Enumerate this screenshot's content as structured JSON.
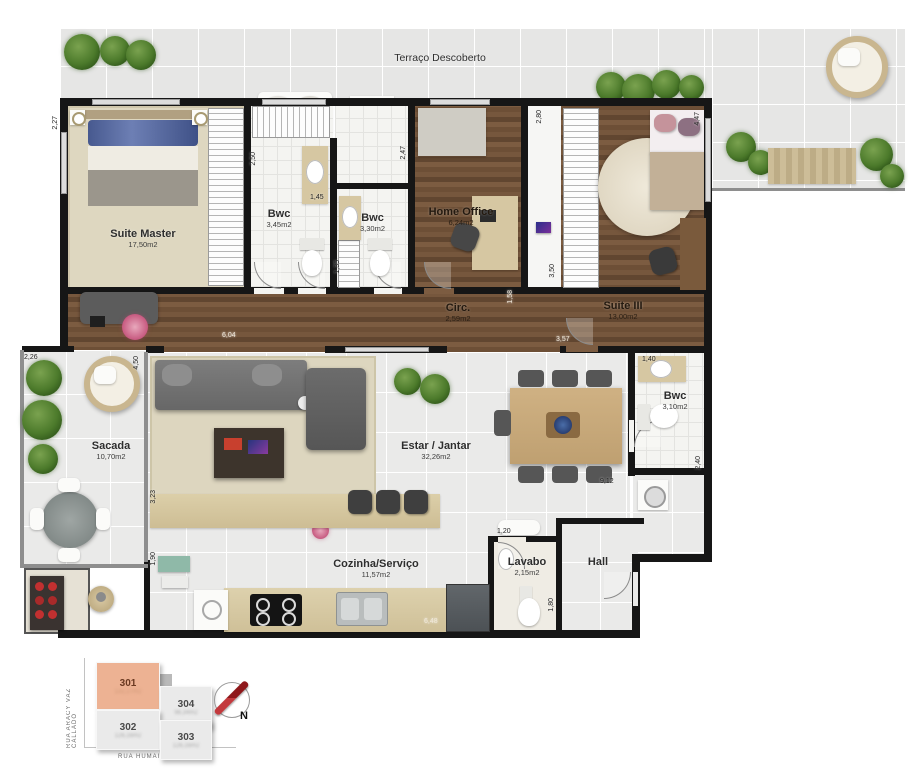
{
  "plan": {
    "rooms": [
      {
        "name": "Terraço Descoberto",
        "area": ""
      },
      {
        "name": "Suite Master",
        "area": "17,50m2"
      },
      {
        "name": "Bwc",
        "area": "3,45m2"
      },
      {
        "name": "Bwc",
        "area": "3,30m2"
      },
      {
        "name": "Home Office",
        "area": "6,24m2"
      },
      {
        "name": "Suite III",
        "area": "13,00m2"
      },
      {
        "name": "Circ.",
        "area": "2,59m2"
      },
      {
        "name": "Sacada",
        "area": "10,70m2"
      },
      {
        "name": "Estar / Jantar",
        "area": "32,26m2"
      },
      {
        "name": "Bwc",
        "area": "3,10m2"
      },
      {
        "name": "Cozinha/Serviço",
        "area": "11,57m2"
      },
      {
        "name": "Lavabo",
        "area": "2,15m2"
      },
      {
        "name": "Hall",
        "area": ""
      }
    ],
    "dims": [
      "2,27",
      "2,50",
      "1,45",
      "2,47",
      "2,80",
      "4,47",
      "6,04",
      "1,35",
      "3,50",
      "1,58",
      "3,57",
      "2,26",
      "4,50",
      "3,23",
      "1,90",
      "1,40",
      "2,40",
      "9,12",
      "1,20",
      "1,80",
      "6,48"
    ]
  },
  "keyplan": {
    "units": [
      {
        "number": "301",
        "area": "132,27m2",
        "selected": true
      },
      {
        "number": "302",
        "area": "126,16m2",
        "selected": false
      },
      {
        "number": "303",
        "area": "126,16m2",
        "selected": false
      },
      {
        "number": "304",
        "area": "98,34m2",
        "selected": false
      }
    ],
    "street_left": "RUA ARACY VAZ CALLADO",
    "street_bottom": "RUA HUMAITÁ",
    "compass": "N"
  },
  "colors": {
    "wall": "#161616",
    "wood": "#6d4f36",
    "tile": "#eaeae9",
    "carpet": "#ded7c0",
    "unit_highlight": "#edb293",
    "compass_red": "#a61c1f"
  }
}
